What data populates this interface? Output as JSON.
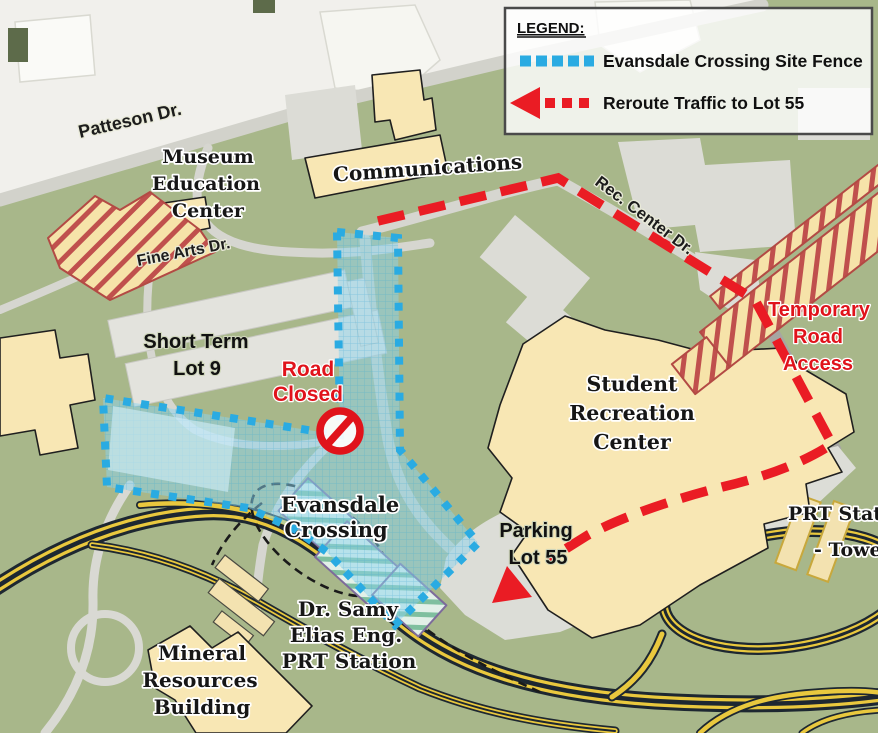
{
  "legend": {
    "title": "LEGEND:",
    "items": [
      {
        "label": "Evansdale Crossing Site Fence",
        "color": "#2aabe2",
        "style": "dotted-line"
      },
      {
        "label": "Reroute Traffic to Lot 55",
        "color": "#ea1c24",
        "style": "dashed-arrow"
      }
    ]
  },
  "roads": {
    "patteson": "Patteson Dr.",
    "fine_arts": "Fine Arts Dr.",
    "rec_center": "Rec. Center Dr."
  },
  "buildings": {
    "museum": [
      "Museum",
      "Education",
      "Center"
    ],
    "communications": "Communications",
    "student_rec": [
      "Student",
      "Recreation",
      "Center"
    ],
    "mineral": [
      "Mineral",
      "Resources",
      "Building"
    ],
    "evansdale": [
      "Evansdale",
      "Crossing"
    ],
    "prt_samy": [
      "Dr. Samy",
      "Elias Eng.",
      "PRT Station"
    ],
    "prt_tower": [
      "PRT Station",
      "- Tower"
    ]
  },
  "areas": {
    "lot9": [
      "Short Term",
      "Lot 9"
    ],
    "lot55": [
      "Parking",
      "Lot 55"
    ]
  },
  "annotations": {
    "road_closed": [
      "Road",
      "Closed"
    ],
    "temp_access": [
      "Temporary",
      "Road",
      "Access"
    ]
  },
  "colors": {
    "map_green": "#a8b78a",
    "offwhite": "#f1f0ec",
    "fence_blue": "#2aabe2",
    "route_red": "#ea1c24",
    "building_yellow": "#f8e7b4",
    "parking_gray": "#dcddd7",
    "highway_yellow": "#e9c83e",
    "highway_dark": "#1d2731",
    "construction_hatch_red": "#c0504d",
    "construction_hatch_purple": "#7d6b9b"
  }
}
